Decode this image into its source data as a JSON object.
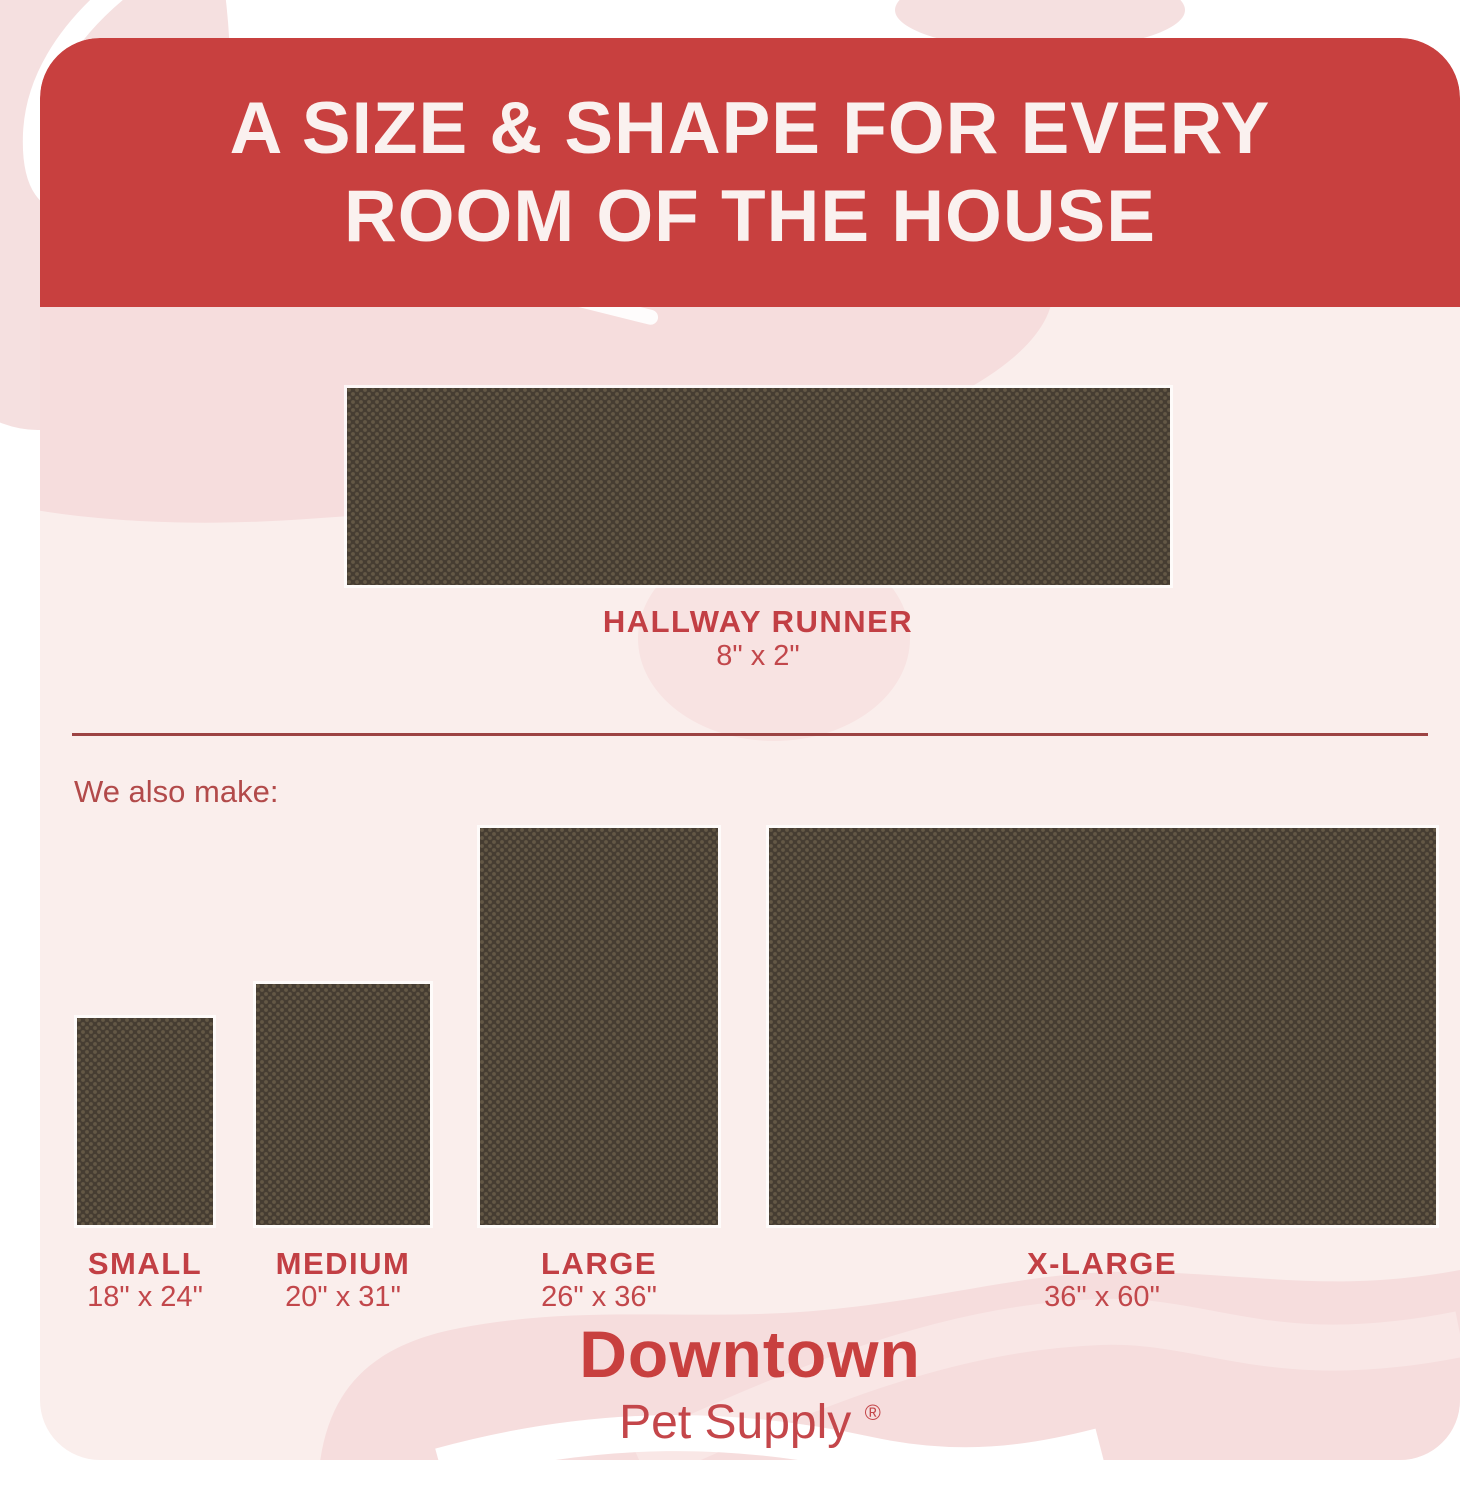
{
  "header": {
    "title_line1": "A SIZE & SHAPE FOR EVERY",
    "title_line2": "ROOM OF THE HOUSE"
  },
  "runner": {
    "name": "HALLWAY RUNNER",
    "dims": "8\" x 2\""
  },
  "also_make": "We also make:",
  "sizes": [
    {
      "name": "SMALL",
      "dims": "18\" x 24\""
    },
    {
      "name": "MEDIUM",
      "dims": "20\" x 31\""
    },
    {
      "name": "LARGE",
      "dims": "26\" x 36\""
    },
    {
      "name": "X-LARGE",
      "dims": "36\" x 60\""
    }
  ],
  "brand": {
    "name": "Downtown",
    "tagline": "Pet Supply",
    "registered": "®"
  },
  "colors": {
    "header_red": "#c8403f",
    "label_red": "#c23f44",
    "divider_red": "#9c4343",
    "card_pink": "#faeeec",
    "blob_pink": "#f6dddd",
    "mat_brown": "#463d32"
  }
}
